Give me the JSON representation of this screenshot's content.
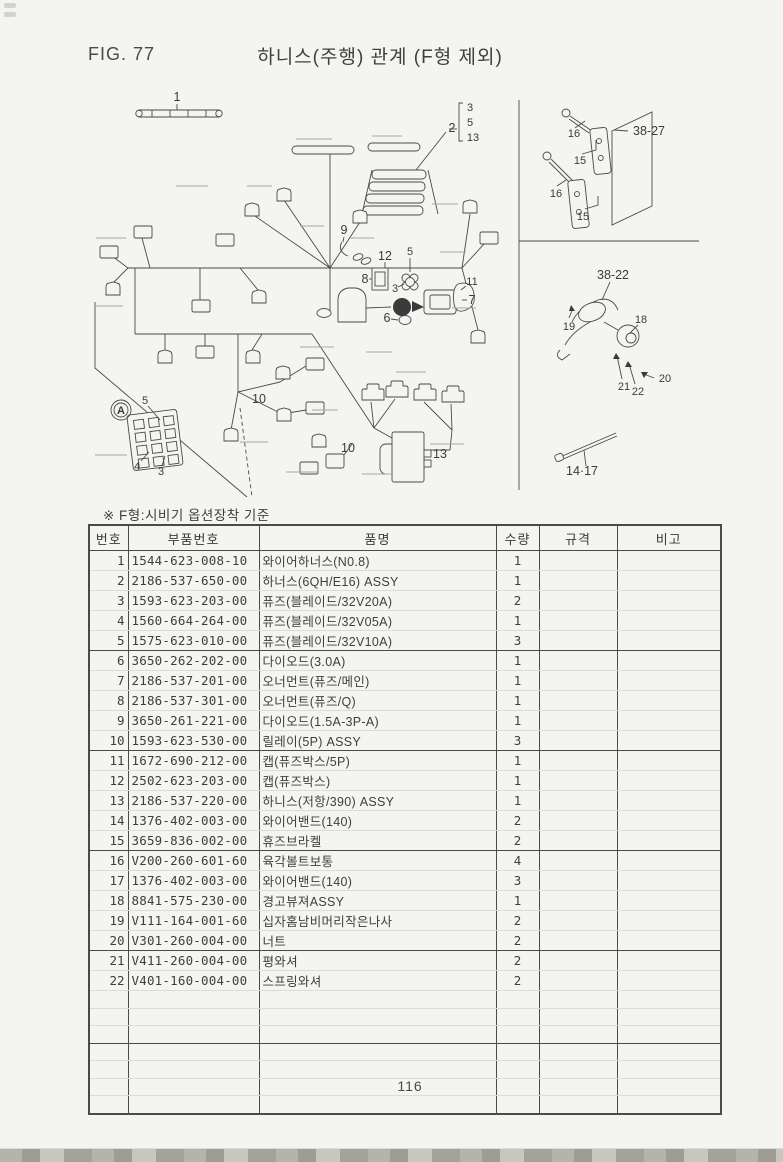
{
  "header": {
    "fig_label": "FIG. 77",
    "title": "하니스(주행) 관계 (F형 제외)"
  },
  "note": "※ F형:시비기 옵션장착 기준",
  "footer": {
    "page_number": "116"
  },
  "diagram": {
    "callouts": [
      {
        "label": "1"
      },
      {
        "label": "2"
      },
      {
        "label": "3"
      },
      {
        "label": "5"
      },
      {
        "label": "13"
      },
      {
        "label": "9"
      },
      {
        "label": "12"
      },
      {
        "label": "5"
      },
      {
        "label": "8"
      },
      {
        "label": "3"
      },
      {
        "label": "6"
      },
      {
        "label": "11"
      },
      {
        "label": "7"
      },
      {
        "label": "A"
      },
      {
        "label": "A"
      },
      {
        "label": "5"
      },
      {
        "label": "4"
      },
      {
        "label": "3"
      },
      {
        "label": "10"
      },
      {
        "label": "10"
      },
      {
        "label": "13"
      },
      {
        "label": "16"
      },
      {
        "label": "15"
      },
      {
        "label": "16"
      },
      {
        "label": "15"
      },
      {
        "label": "38-27"
      },
      {
        "label": "38-22"
      },
      {
        "label": "19"
      },
      {
        "label": "18"
      },
      {
        "label": "21"
      },
      {
        "label": "22"
      },
      {
        "label": "20"
      },
      {
        "label": "14·17"
      }
    ]
  },
  "table": {
    "headers": [
      "번호",
      "부품번호",
      "품명",
      "수량",
      "규격",
      "비고"
    ],
    "rows": [
      {
        "no": "1",
        "part_no": "1544-623-008-10",
        "name": "와이어하너스(N0.8)",
        "qty": "1",
        "spec": "",
        "remark": ""
      },
      {
        "no": "2",
        "part_no": "2186-537-650-00",
        "name": "하너스(6QH/E16) ASSY",
        "qty": "1",
        "spec": "",
        "remark": ""
      },
      {
        "no": "3",
        "part_no": "1593-623-203-00",
        "name": "퓨즈(블레이드/32V20A)",
        "qty": "2",
        "spec": "",
        "remark": ""
      },
      {
        "no": "4",
        "part_no": "1560-664-264-00",
        "name": "퓨즈(블레이드/32V05A)",
        "qty": "1",
        "spec": "",
        "remark": ""
      },
      {
        "no": "5",
        "part_no": "1575-623-010-00",
        "name": "퓨즈(블레이드/32V10A)",
        "qty": "3",
        "spec": "",
        "remark": ""
      },
      {
        "no": "6",
        "part_no": "3650-262-202-00",
        "name": "다이오드(3.0A)",
        "qty": "1",
        "spec": "",
        "remark": ""
      },
      {
        "no": "7",
        "part_no": "2186-537-201-00",
        "name": "오너먼트(퓨즈/메인)",
        "qty": "1",
        "spec": "",
        "remark": ""
      },
      {
        "no": "8",
        "part_no": "2186-537-301-00",
        "name": "오너먼트(퓨즈/Q)",
        "qty": "1",
        "spec": "",
        "remark": ""
      },
      {
        "no": "9",
        "part_no": "3650-261-221-00",
        "name": "다이오드(1.5A-3P-A)",
        "qty": "1",
        "spec": "",
        "remark": ""
      },
      {
        "no": "10",
        "part_no": "1593-623-530-00",
        "name": "릴레이(5P) ASSY",
        "qty": "3",
        "spec": "",
        "remark": ""
      },
      {
        "no": "11",
        "part_no": "1672-690-212-00",
        "name": "캡(퓨즈박스/5P)",
        "qty": "1",
        "spec": "",
        "remark": ""
      },
      {
        "no": "12",
        "part_no": "2502-623-203-00",
        "name": "캡(퓨즈박스)",
        "qty": "1",
        "spec": "",
        "remark": ""
      },
      {
        "no": "13",
        "part_no": "2186-537-220-00",
        "name": "하니스(저항/390) ASSY",
        "qty": "1",
        "spec": "",
        "remark": ""
      },
      {
        "no": "14",
        "part_no": "1376-402-003-00",
        "name": "와이어밴드(140)",
        "qty": "2",
        "spec": "",
        "remark": ""
      },
      {
        "no": "15",
        "part_no": "3659-836-002-00",
        "name": "휴즈브라켈",
        "qty": "2",
        "spec": "",
        "remark": ""
      },
      {
        "no": "16",
        "part_no": "V200-260-601-60",
        "name": "육각볼트보통",
        "qty": "4",
        "spec": "",
        "remark": ""
      },
      {
        "no": "17",
        "part_no": "1376-402-003-00",
        "name": "와이어밴드(140)",
        "qty": "3",
        "spec": "",
        "remark": ""
      },
      {
        "no": "18",
        "part_no": "8841-575-230-00",
        "name": "경고뷰져ASSY",
        "qty": "1",
        "spec": "",
        "remark": ""
      },
      {
        "no": "19",
        "part_no": "V111-164-001-60",
        "name": "십자홈남비머리작은나사",
        "qty": "2",
        "spec": "",
        "remark": ""
      },
      {
        "no": "20",
        "part_no": "V301-260-004-00",
        "name": "너트",
        "qty": "2",
        "spec": "",
        "remark": ""
      },
      {
        "no": "21",
        "part_no": "V411-260-004-00",
        "name": "평와셔",
        "qty": "2",
        "spec": "",
        "remark": ""
      },
      {
        "no": "22",
        "part_no": "V401-160-004-00",
        "name": "스프링와셔",
        "qty": "2",
        "spec": "",
        "remark": ""
      }
    ],
    "empty_row_count": 7
  }
}
